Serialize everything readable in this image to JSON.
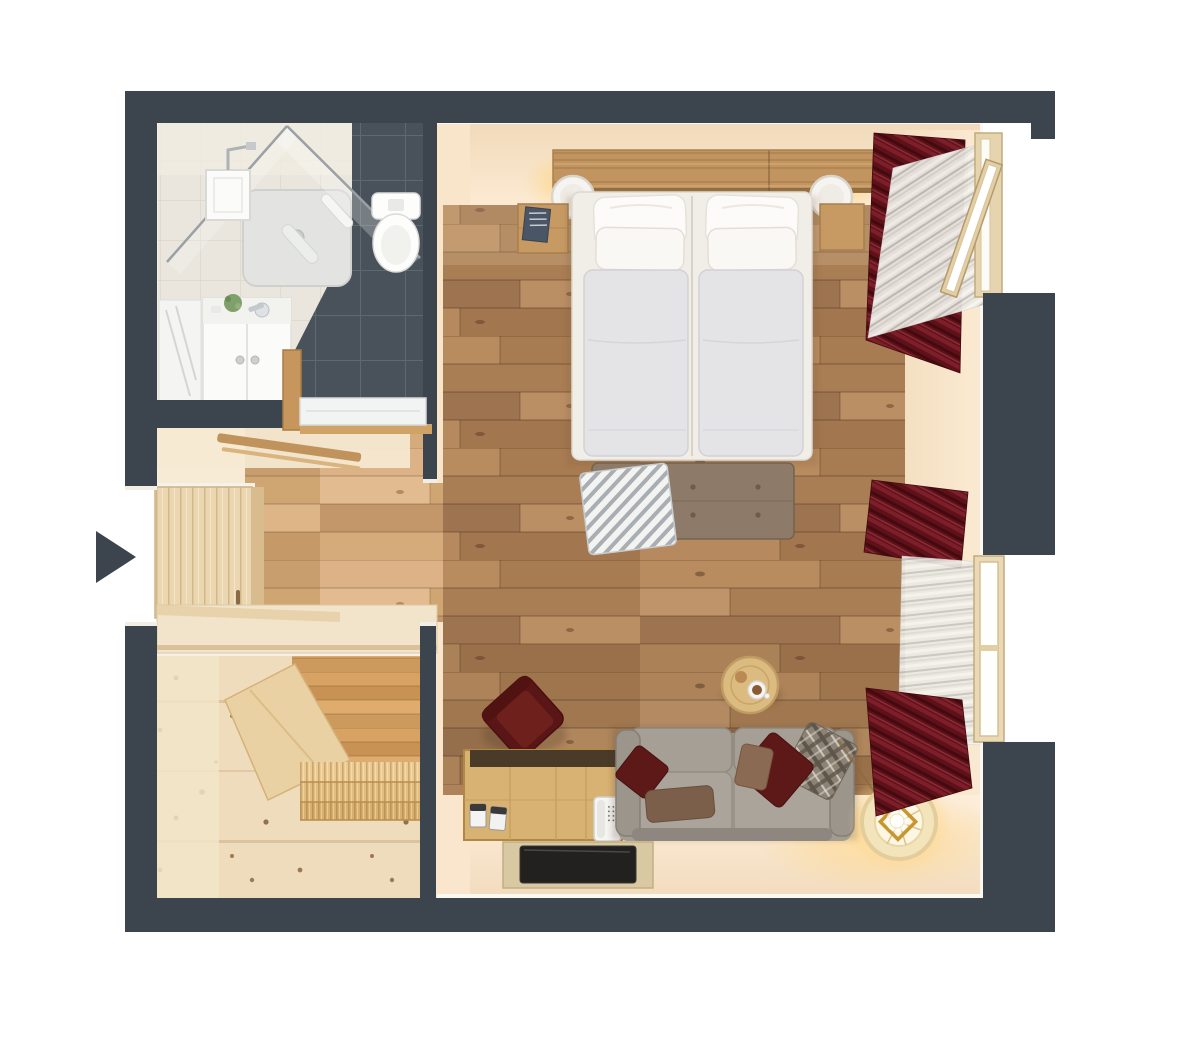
{
  "meta": {
    "title": "Top-down 3D floor plan render: studio apartment with bathroom, entry hallway, sauna and combined living-bedroom",
    "view": "top-down 3D render"
  },
  "palette": {
    "canvas": "#ffffff",
    "wall": "#3c454d",
    "wall_face_cream": "#f8e5ca",
    "floor_wood": "#b08358",
    "floor_wood_light": "#d2a877",
    "sauna_pine": "#eedcbc",
    "curtain_maroon": "#5e1119",
    "sheer_curtain": "#eceae4",
    "sofa_gray": "#a29c93",
    "bed_white": "#f1eee8",
    "duvet_gray": "#e4e4e6",
    "pillow_white": "#fcfbf9",
    "bench_taupe": "#8d7a69",
    "oak_wood": "#c2945f",
    "chest_wood": "#d8b272",
    "armchair_maroon": "#5a1616",
    "tile_dark": "#49525a",
    "tile_light": "#eae6dd",
    "lamp_glow": "#ffd98f",
    "tv_black": "#232120"
  },
  "rooms": [
    {
      "id": "bathroom",
      "name": "bathroom",
      "fixtures": [
        "shower-tray",
        "rain-shower-head",
        "glass-partition",
        "toilet",
        "vanity-sink",
        "mirror",
        "sliding-door"
      ]
    },
    {
      "id": "hallway",
      "name": "entry-hallway",
      "fixtures": [
        "entry-door",
        "coat-shelf",
        "hall-bench"
      ]
    },
    {
      "id": "sauna",
      "name": "sauna",
      "fixtures": [
        "tiered-bench",
        "step-platforms"
      ]
    },
    {
      "id": "living_bedroom",
      "name": "living-bedroom",
      "fixtures": [
        "headboard",
        "double-bed",
        "wall-lamp-left",
        "wall-lamp-right",
        "nightstand-left",
        "nightstand-right",
        "foot-bench",
        "striped-throw",
        "side-table",
        "armchair",
        "storage-chest",
        "telephone",
        "sofa",
        "cushions",
        "flat-panel",
        "floor-lamp",
        "curtains",
        "window-open",
        "window-closed"
      ]
    }
  ],
  "indicators": {
    "entry_arrow_direction": "right"
  }
}
